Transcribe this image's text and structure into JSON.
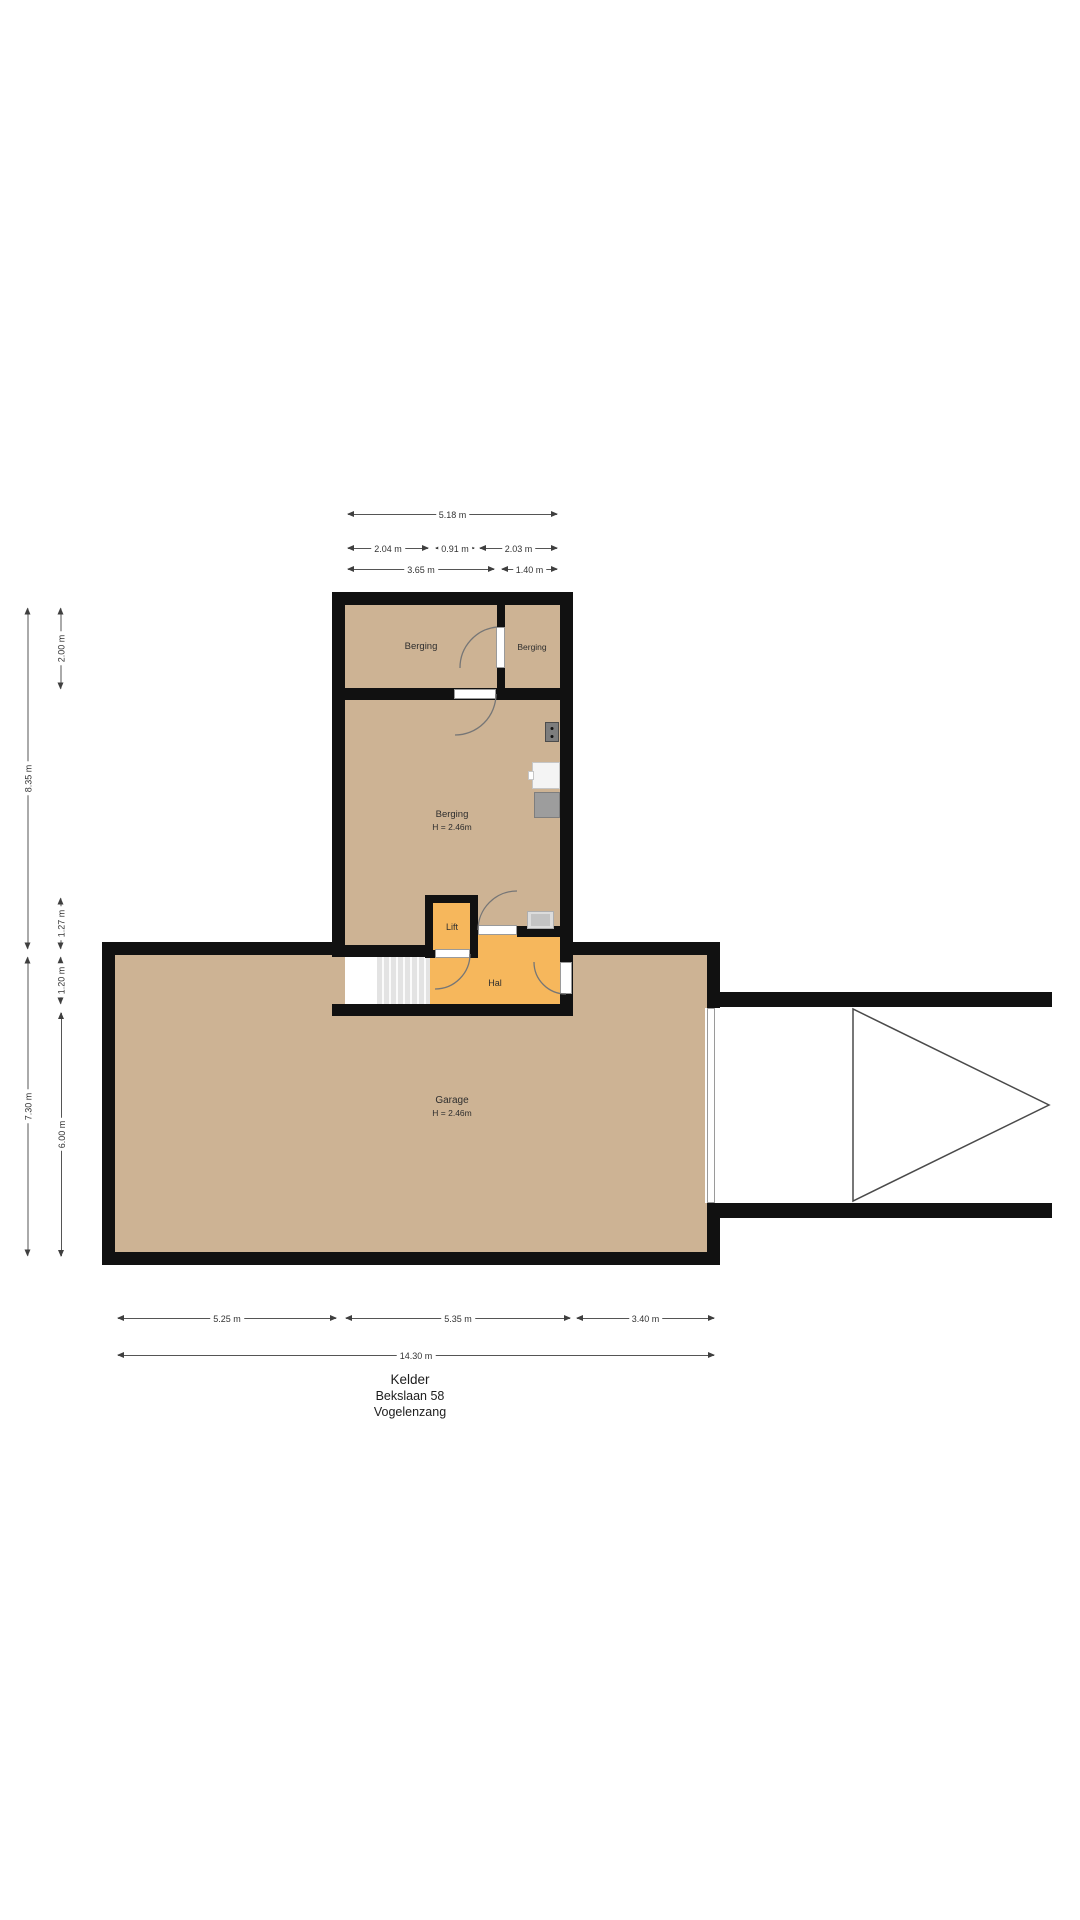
{
  "title": {
    "line1": "Kelder",
    "line2": "Bekslaan 58",
    "line3": "Vogelenzang"
  },
  "rooms": {
    "berging_top_left": {
      "label": "Berging"
    },
    "berging_top_right": {
      "label": "Berging"
    },
    "berging_main": {
      "label": "Berging",
      "height": "H = 2.46m"
    },
    "lift": {
      "label": "Lift"
    },
    "hal": {
      "label": "Hal"
    },
    "garage": {
      "label": "Garage",
      "height": "H = 2.46m"
    }
  },
  "dimensions": {
    "top": [
      {
        "label": "5.18 m"
      },
      {
        "label": "2.04 m"
      },
      {
        "label": "0.91 m"
      },
      {
        "label": "2.03 m"
      },
      {
        "label": "3.65 m"
      },
      {
        "label": "1.40 m"
      }
    ],
    "left": [
      {
        "label": "8.35 m"
      },
      {
        "label": "7.30 m"
      },
      {
        "label": "2.00 m"
      },
      {
        "label": "1.27 m"
      },
      {
        "label": "1.20 m"
      },
      {
        "label": "6.00 m"
      }
    ],
    "bottom": [
      {
        "label": "5.25 m"
      },
      {
        "label": "5.35 m"
      },
      {
        "label": "3.40 m"
      },
      {
        "label": "14.30 m"
      }
    ]
  },
  "icons": {
    "meter": "meter-cabinet",
    "white_unit": "worktop",
    "gray_unit": "boiler",
    "mat": "doormat",
    "driveway": "driveway-arrow"
  },
  "colors": {
    "floor_tan": "#cdb394",
    "floor_orange": "#f6b75c",
    "wall": "#111111",
    "dimension_text": "#333333"
  }
}
